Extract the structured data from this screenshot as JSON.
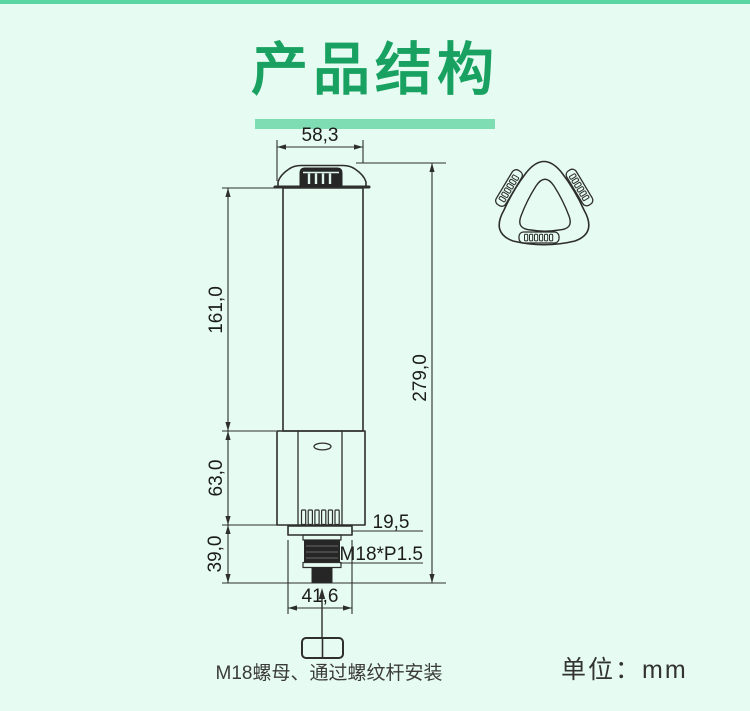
{
  "header": {
    "title": "产品结构"
  },
  "drawing": {
    "dims": {
      "cap_width": "58,3",
      "body_height": "161,0",
      "total_height": "279,0",
      "base_height": "63,0",
      "mount_height": "39,0",
      "plate_note": "19,5",
      "thread_spec": "M18*P1.5",
      "plate_width": "41,6"
    },
    "caption": "M18螺母、通过螺纹杆安装"
  },
  "footer": {
    "unit_label": "单位：mm"
  },
  "colors": {
    "background": "#e6fbf1",
    "accent_green": "#18a160",
    "underline_green": "#7eddb2",
    "top_bar_green": "#5ad6a5",
    "line": "#2e2e2e"
  }
}
